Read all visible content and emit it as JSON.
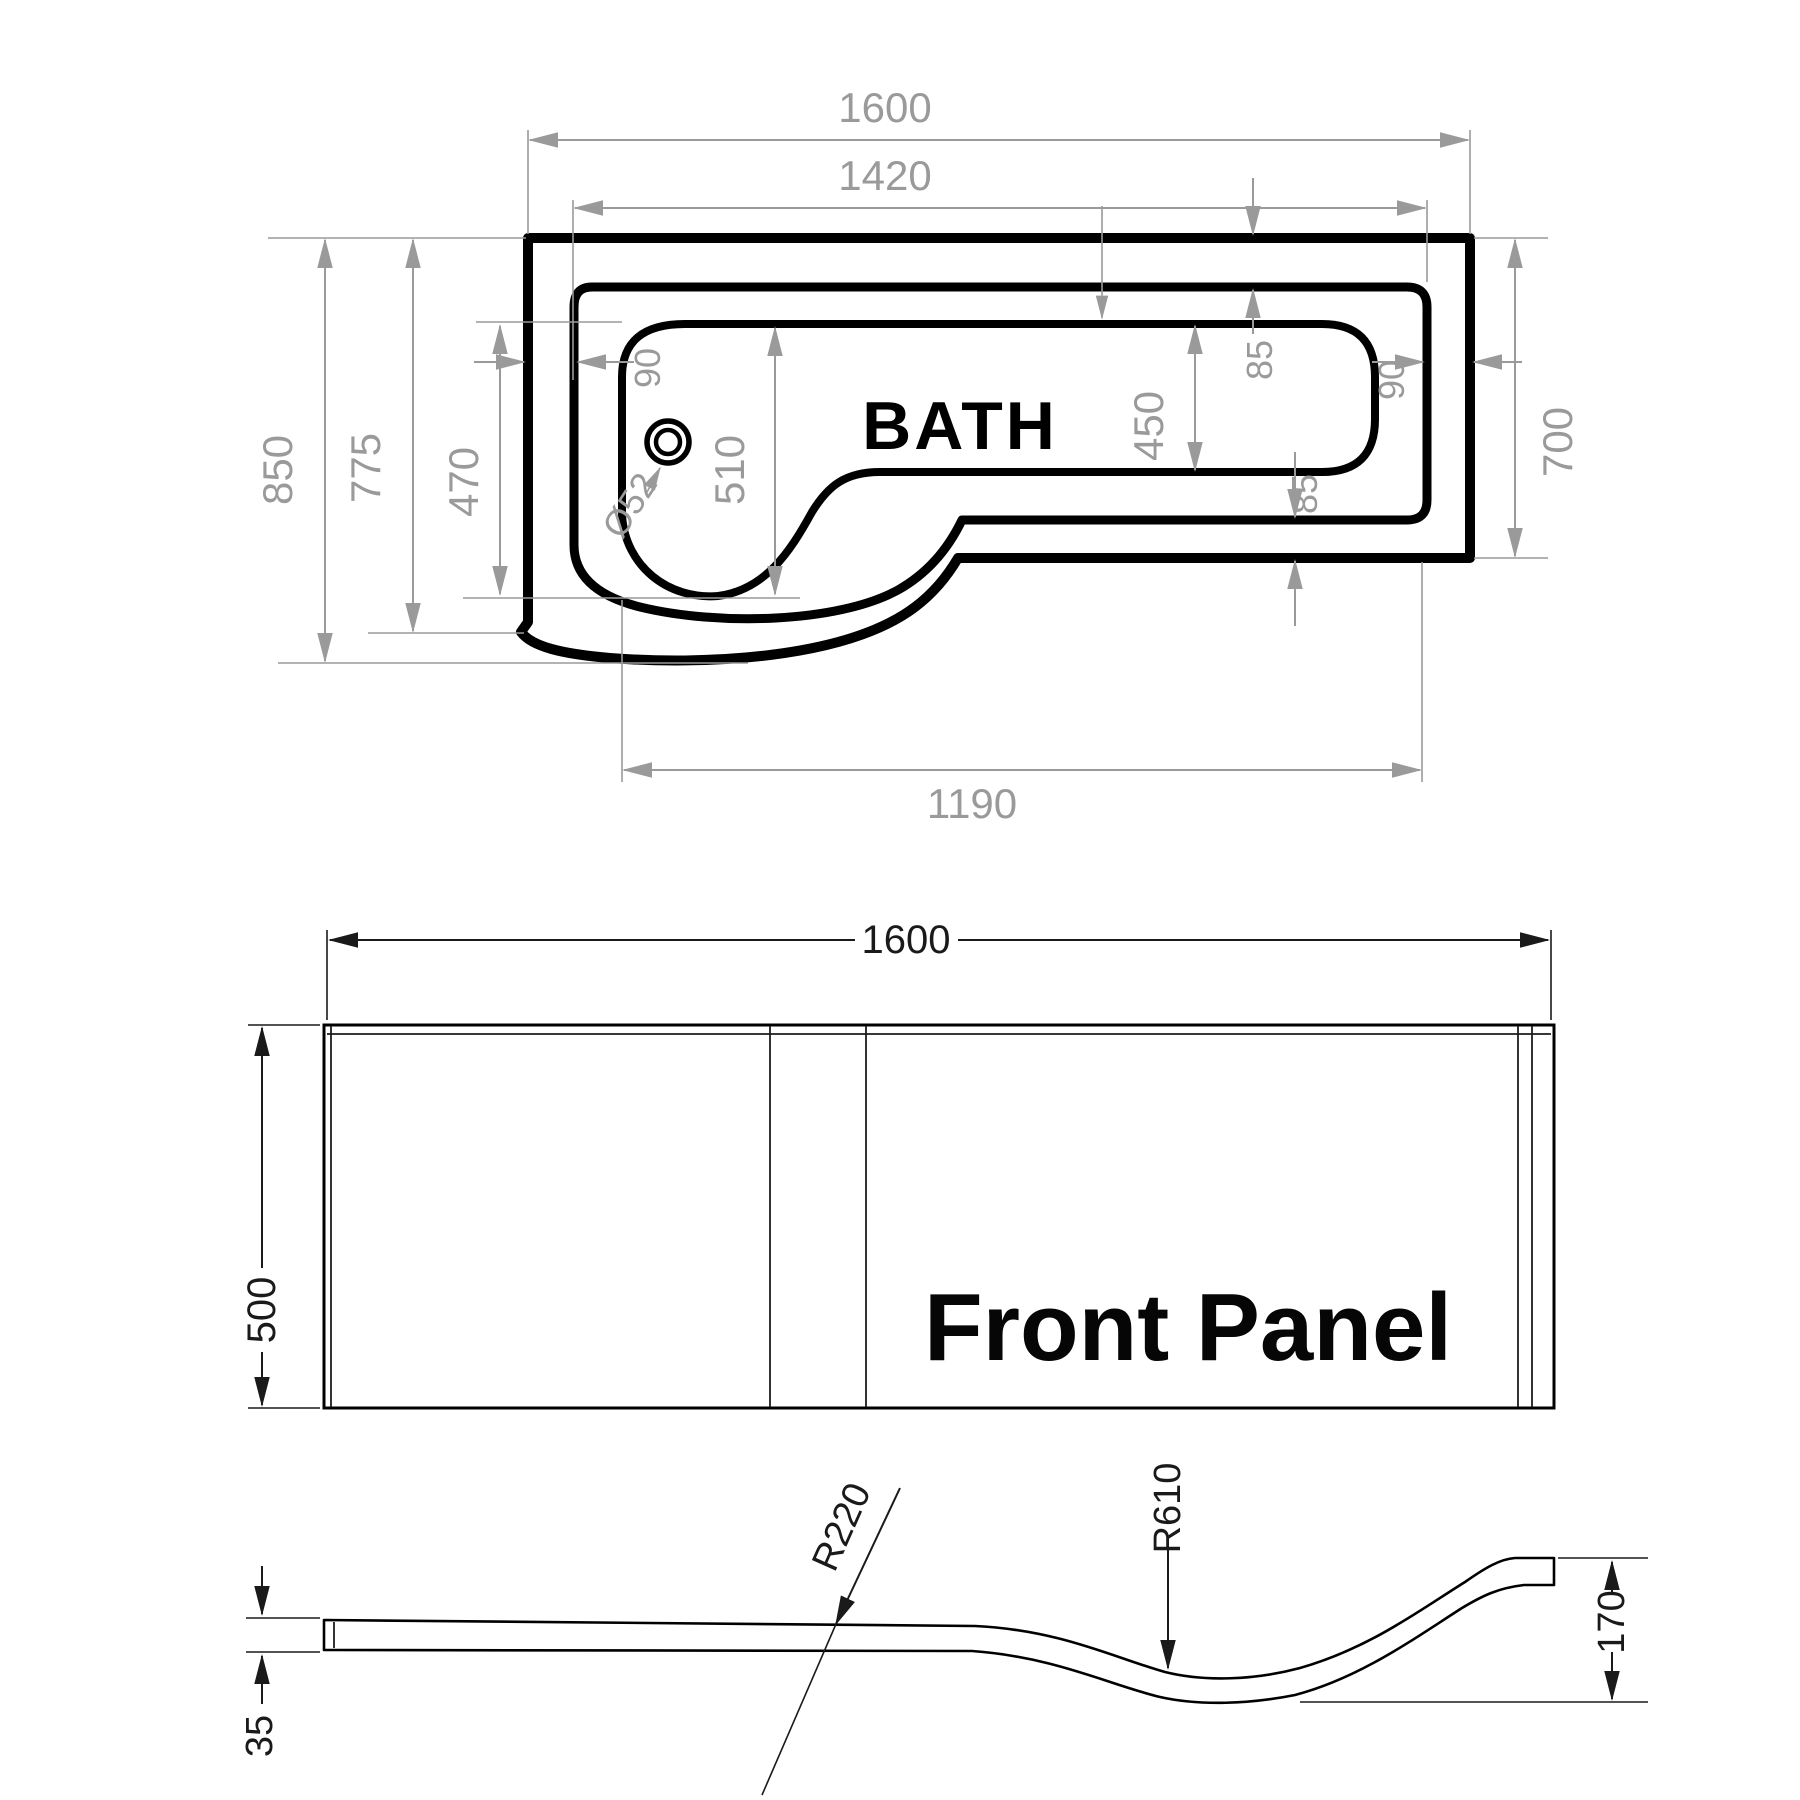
{
  "top_view": {
    "title": "BATH",
    "dim_width_overall": "1600",
    "dim_width_rim": "1420",
    "dim_depth_overall": "850",
    "dim_depth_rim": "775",
    "dim_shower_470": "470",
    "dim_shower_inner": "510",
    "dim_drain": "Ø52",
    "dim_rim_left": "90",
    "dim_rim_right": "90",
    "dim_edge_top": "85",
    "dim_edge_bottom": "85",
    "dim_inner_depth": "450",
    "dim_depth_right": "700",
    "dim_bottom_length": "1190"
  },
  "front_panel": {
    "title": "Front Panel",
    "dim_width": "1600",
    "dim_height": "500"
  },
  "side_profile": {
    "dim_thickness": "35",
    "dim_radius_upper": "R220",
    "dim_radius_lower": "R610",
    "dim_end_height": "170"
  },
  "colors": {
    "line": "#000000",
    "dim_gray": "#9a9a9a",
    "dim_dark": "#1a1a1a",
    "bg": "#ffffff"
  }
}
